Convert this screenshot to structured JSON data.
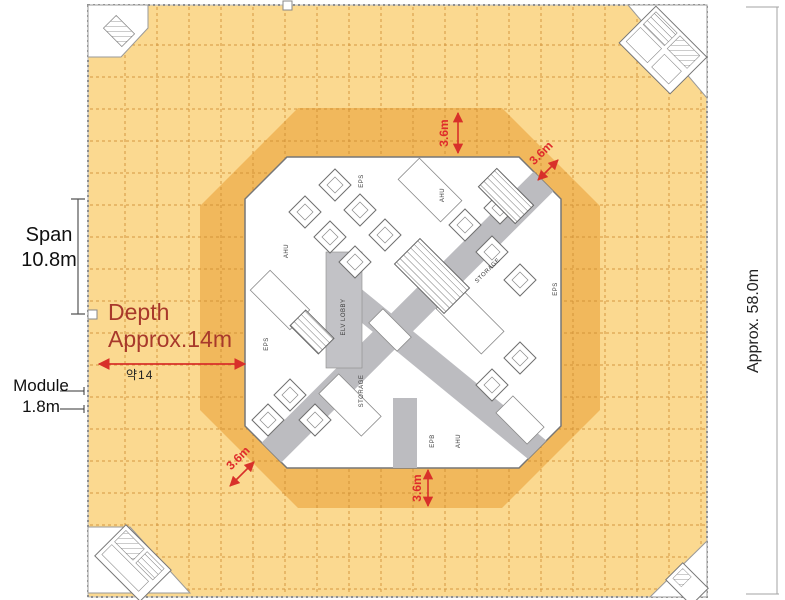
{
  "annotations": {
    "span_label": "Span",
    "span_value": "10.8m",
    "depth_label": "Depth",
    "depth_value": "Approx.14m",
    "depth_note": "약14",
    "module_label": "Module",
    "module_value": "1.8m",
    "overall_width": "Approx. 58.0m",
    "band_top": "3.6m",
    "band_right": "3.6m",
    "band_bottom": "3.6m",
    "band_left": "3.6m"
  },
  "core": {
    "labels": [
      {
        "text": "AHU"
      },
      {
        "text": "EPS"
      },
      {
        "text": "ELV LOBBY"
      },
      {
        "text": "STORAGE"
      },
      {
        "text": "STORAGE"
      },
      {
        "text": "EPS"
      },
      {
        "text": "AHU"
      },
      {
        "text": "EPS"
      },
      {
        "text": "EPB"
      },
      {
        "text": "AHU"
      }
    ]
  },
  "colors": {
    "floor": "#FBD990",
    "inner_band": "#F1B85C",
    "grid_line": "#CE8C33",
    "corridor": "#BCBCC0",
    "dimension_red": "#D8302A",
    "depth_text": "#A8392B"
  }
}
